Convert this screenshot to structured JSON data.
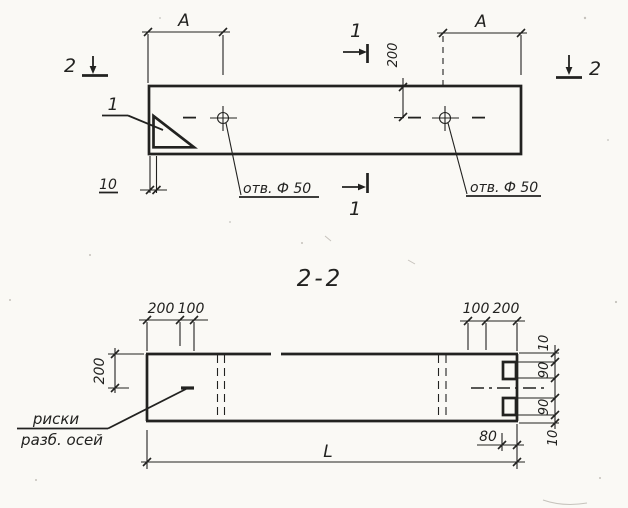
{
  "colors": {
    "ink": "#222220",
    "paper": "#faf9f5"
  },
  "plan_view": {
    "dim_span_left": "A",
    "dim_span_right": "A",
    "dim_hole_offset": "200",
    "dim_end_offset": "10",
    "hole_note_left": "отв. Ф 50",
    "hole_note_right": "отв. Ф 50",
    "detail_mark": "1",
    "section_1_top": "1",
    "section_1_bottom": "1",
    "section_2_left": "2",
    "section_2_right": "2"
  },
  "section_view": {
    "title": "2-2",
    "top_left_dims": [
      "200",
      "100"
    ],
    "top_right_dims": [
      "100",
      "200"
    ],
    "left_dim": "200",
    "right_dims": [
      "10",
      "90",
      "90",
      "10"
    ],
    "dim_notch": "80",
    "dim_length": "L",
    "axis_note_line1": "риски",
    "axis_note_line2": "разб. осей"
  }
}
